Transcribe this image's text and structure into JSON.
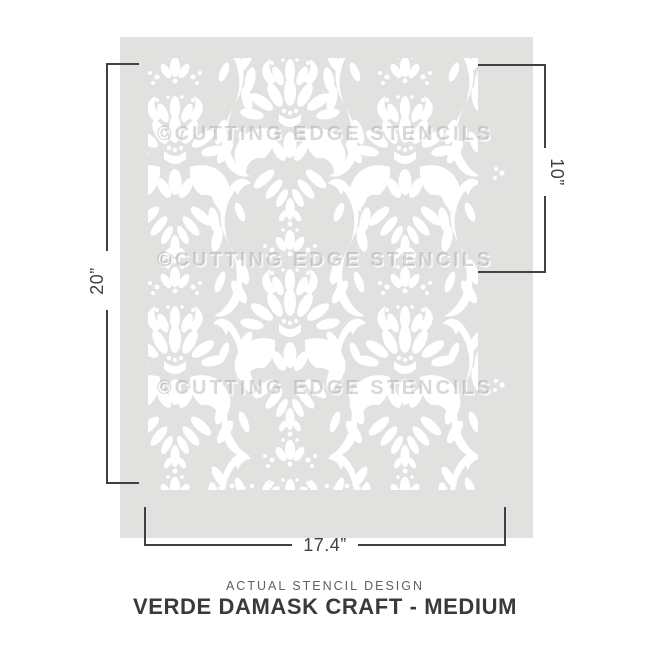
{
  "colors": {
    "page_bg": "#ffffff",
    "sheet": "#e1e1df",
    "pattern": "#ffffff",
    "dim": "#414141",
    "watermark": "#8e8e8e59",
    "caption_subtitle": "#5f5f63",
    "caption_title": "#3a3a3c"
  },
  "sheet": {
    "watermark_text": "©CUTTING EDGE STENCILS",
    "pattern_name": "damask"
  },
  "dimensions": {
    "height": "20”",
    "partial_height": "10”",
    "width": "17.4”"
  },
  "caption": {
    "subtitle": "ACTUAL STENCIL DESIGN",
    "title": "VERDE DAMASK CRAFT - MEDIUM"
  }
}
